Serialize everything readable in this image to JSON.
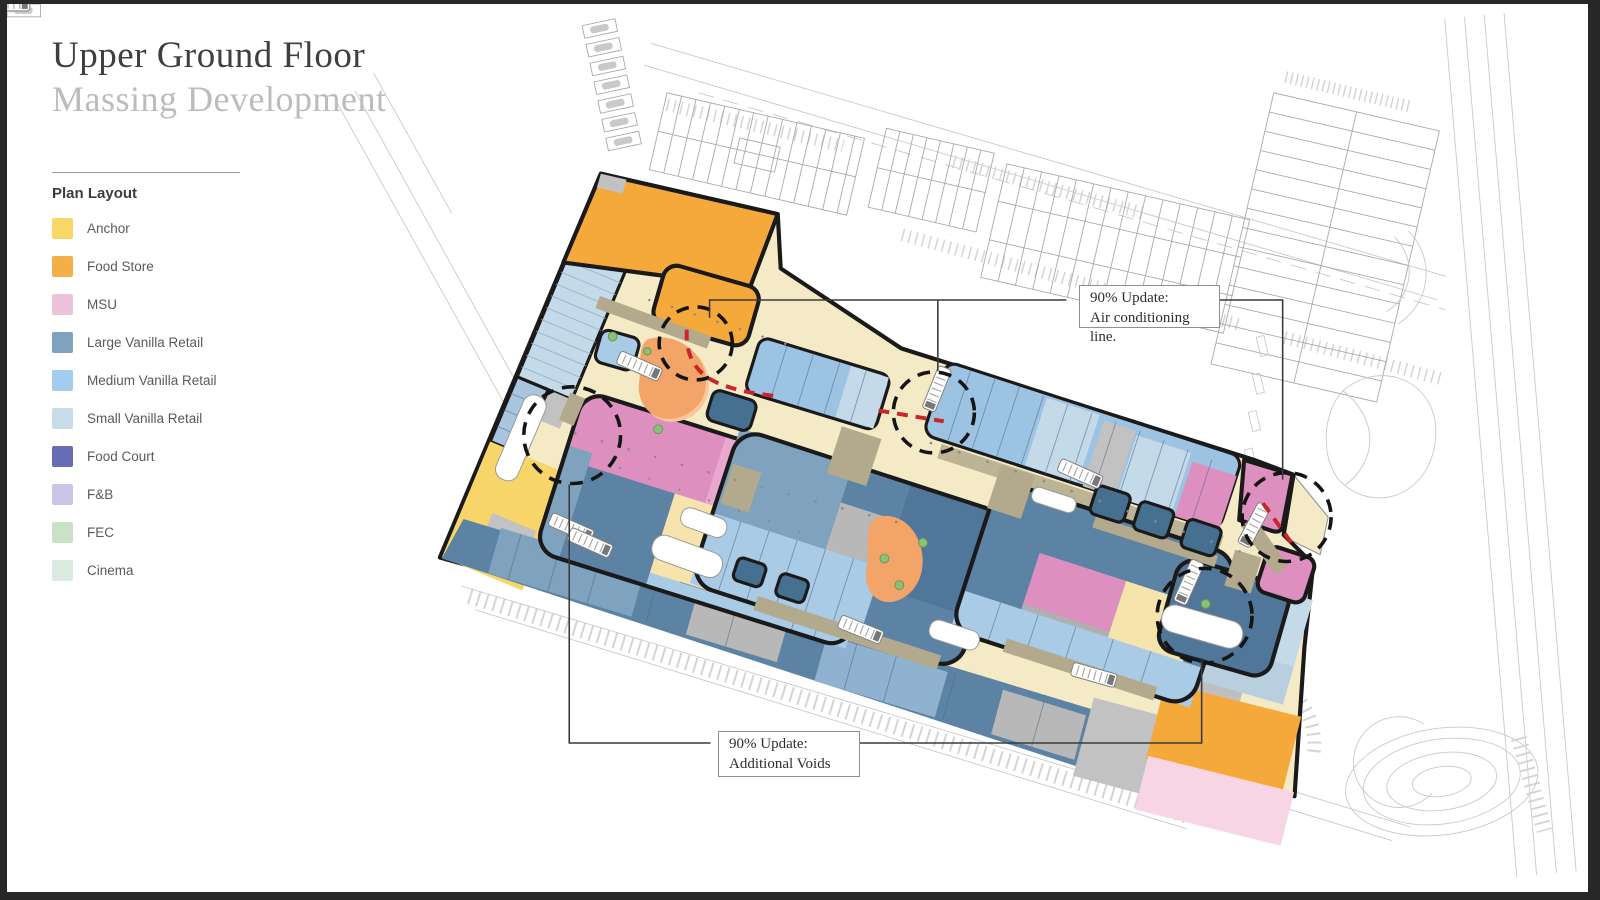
{
  "page": {
    "title_line1": "Upper Ground Floor",
    "title_line2": "Massing Development"
  },
  "legend": {
    "heading": "Plan Layout",
    "items": [
      {
        "label": "Anchor",
        "color": "#F8D767"
      },
      {
        "label": "Food Store",
        "color": "#F5AF49"
      },
      {
        "label": "MSU",
        "color": "#EFC2DC"
      },
      {
        "label": "Large Vanilla Retail",
        "color": "#7FA2BE"
      },
      {
        "label": "Medium Vanilla Retail",
        "color": "#A3CDEF"
      },
      {
        "label": "Small Vanilla Retail",
        "color": "#C7DBE9"
      },
      {
        "label": "Food Court",
        "color": "#666DB4"
      },
      {
        "label": "F&B",
        "color": "#C9C5E6"
      },
      {
        "label": "FEC",
        "color": "#C7E2C5"
      },
      {
        "label": "Cinema",
        "color": "#D8EBDE"
      }
    ]
  },
  "callouts": {
    "air_conditioning": {
      "line1": "90% Update:",
      "line2": "Air conditioning line."
    },
    "additional_voids": {
      "line1": "90% Update:",
      "line2": "Additional Voids"
    }
  },
  "plan_colors": {
    "corridor": "#F5EAC6",
    "anchor": "#F7D569",
    "food_store": "#F5A93B",
    "msu": "#DD8FC0",
    "msu_light": "#E9A8CE",
    "msu_pale": "#F7D5E5",
    "large_vanilla": "#5D83A4",
    "large_deep": "#50779A",
    "slate_vanilla": "#7FA2BE",
    "medium_vanilla": "#9DC3E3",
    "small_vanilla": "#C4DAE9",
    "pale_rows": "#A9C6DE",
    "cream_cell": "#F7E3AC",
    "service_gray": "#C2C2C2",
    "walkway_tan": "#B3A98C",
    "landscape_orange": "#F2A469",
    "tree_green": "#8FBF77",
    "update_red": "#C9252B"
  }
}
